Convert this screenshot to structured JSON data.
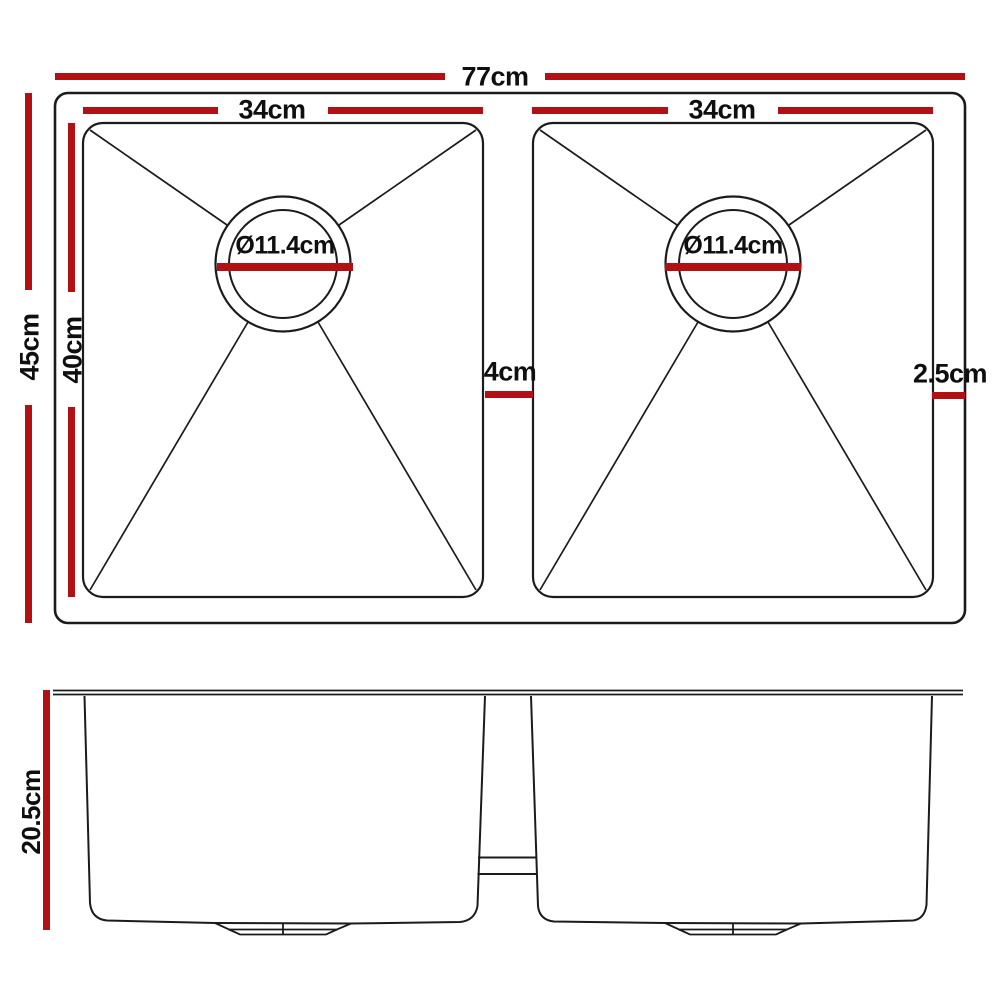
{
  "colors": {
    "dimension_red": "#b11015",
    "line_black": "#1b1b1b",
    "text_black": "#0f0f0f",
    "background": "#ffffff"
  },
  "top_view": {
    "dims": {
      "overall_width": "77cm",
      "overall_depth": "45cm",
      "bowl_inner_depth": "40cm",
      "left_bowl_width": "34cm",
      "right_bowl_width": "34cm",
      "left_drain_diameter": "Ø11.4cm",
      "right_drain_diameter": "Ø11.4cm",
      "center_divider_gap": "4cm",
      "right_edge_gap": "2.5cm"
    }
  },
  "side_view": {
    "dims": {
      "bowl_height": "20.5cm"
    }
  }
}
